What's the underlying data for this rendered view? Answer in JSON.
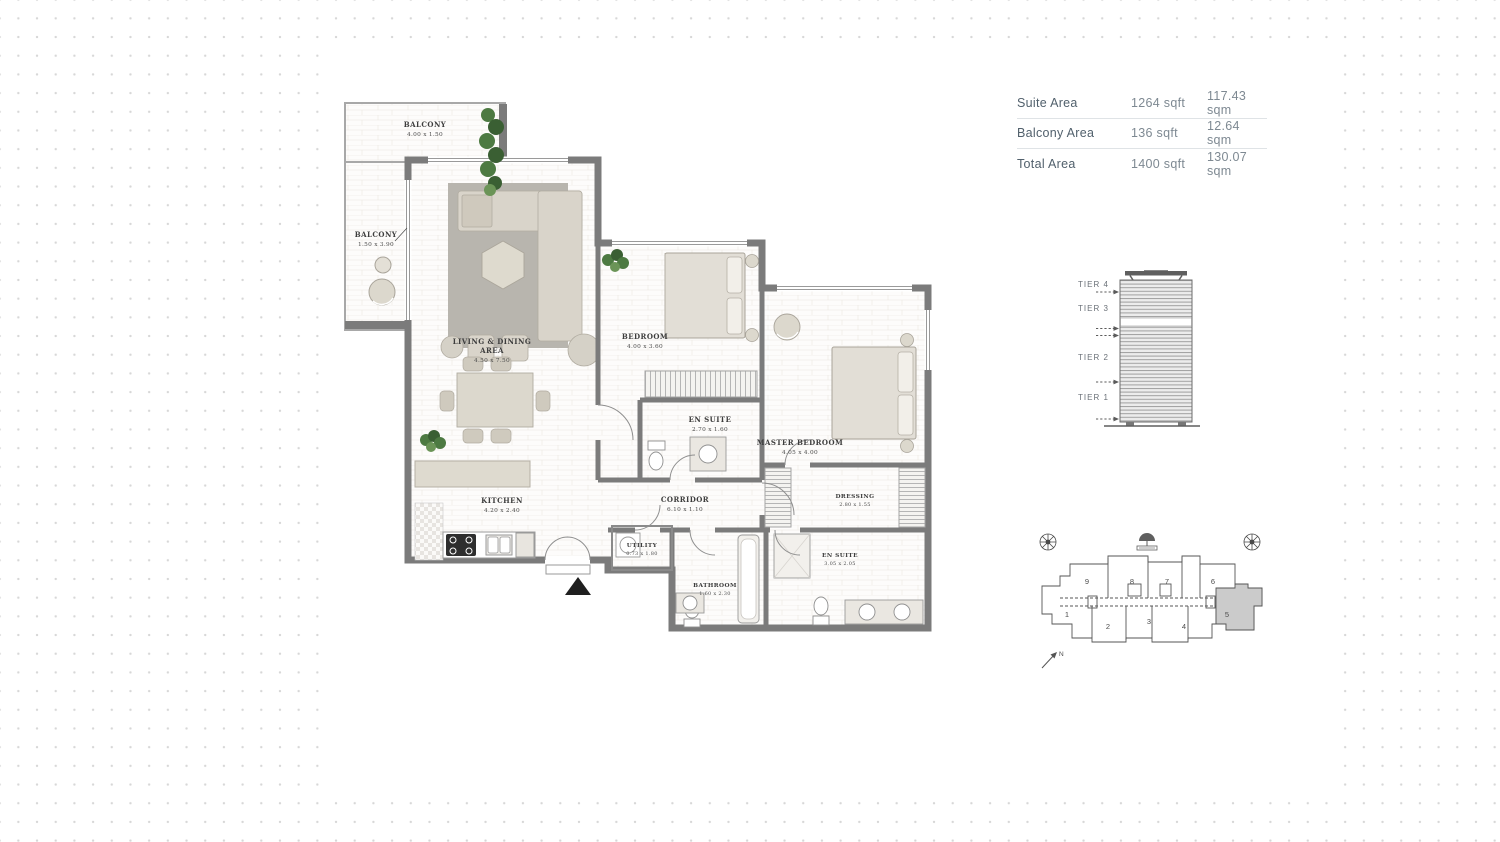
{
  "area_table": {
    "rows": [
      {
        "label": "Suite Area",
        "sqft": "1264 sqft",
        "sqm": "117.43 sqm"
      },
      {
        "label": "Balcony Area",
        "sqft": "136 sqft",
        "sqm": "12.64 sqm"
      },
      {
        "label": "Total Area",
        "sqft": "1400 sqft",
        "sqm": "130.07 sqm"
      }
    ]
  },
  "tier_diagram": {
    "tiers": [
      {
        "label": "TIER 4"
      },
      {
        "label": "TIER 3"
      },
      {
        "label": "TIER 2"
      },
      {
        "label": "TIER 1"
      }
    ]
  },
  "site_plan": {
    "units": [
      {
        "n": "1"
      },
      {
        "n": "2"
      },
      {
        "n": "3"
      },
      {
        "n": "4"
      },
      {
        "n": "5"
      },
      {
        "n": "6"
      },
      {
        "n": "7"
      },
      {
        "n": "8"
      },
      {
        "n": "9"
      }
    ],
    "highlighted_unit": "5",
    "north_label": "N"
  },
  "floor_plan": {
    "rooms": [
      {
        "name": "BALCONY",
        "dims": "4.00 x 1.50"
      },
      {
        "name": "BALCONY",
        "dims": "1.50 x 3.90"
      },
      {
        "name": "LIVING & DINING",
        "name2": "AREA",
        "dims": "4.50 x 7.50"
      },
      {
        "name": "BEDROOM",
        "dims": "4.00 x 3.60"
      },
      {
        "name": "EN SUITE",
        "dims": "2.70 x 1.60"
      },
      {
        "name": "MASTER BEDROOM",
        "dims": "4.05 x 4.00"
      },
      {
        "name": "DRESSING",
        "dims": "2.80 x 1.55"
      },
      {
        "name": "KITCHEN",
        "dims": "4.20 x 2.40"
      },
      {
        "name": "CORRIDOR",
        "dims": "6.10 x 1.10"
      },
      {
        "name": "UTILITY",
        "dims": "0.73 x 1.80"
      },
      {
        "name": "BATHROOM",
        "dims": "1.60 x 2.30"
      },
      {
        "name": "EN SUITE",
        "dims": "3.05 x 2.05"
      }
    ]
  },
  "colors": {
    "wall": "#7b7b7b",
    "furniture": "#d9d4ca",
    "rug": "#b8b5ae",
    "plant_green": "#4d7a42",
    "highlighted_unit_fill": "#cbcbcb",
    "dot_grid": "#d7d7d7",
    "table_label": "#51606c",
    "table_value": "#7e8992"
  }
}
